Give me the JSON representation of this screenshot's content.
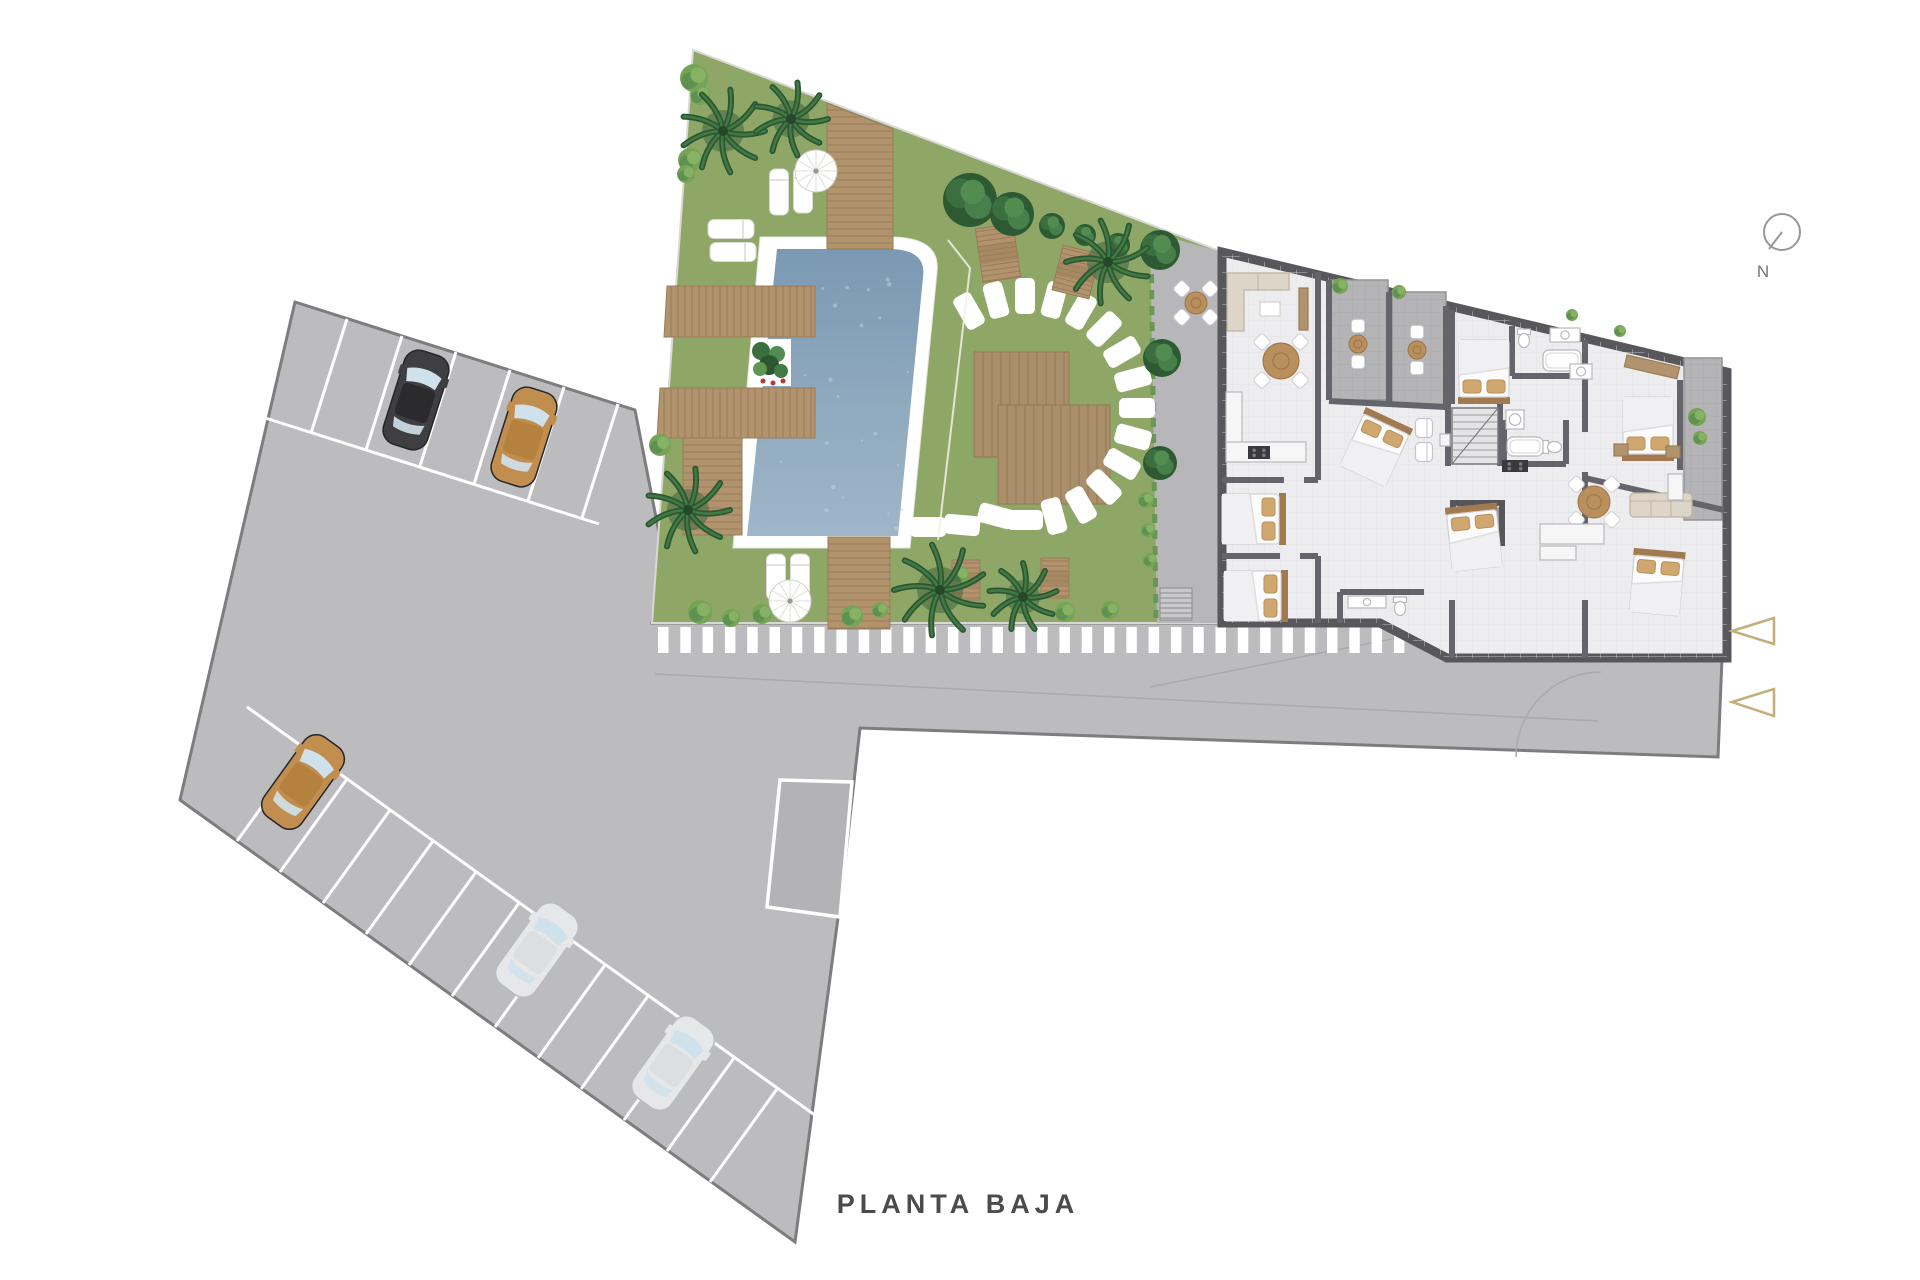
{
  "labels": {
    "title": "PLANTA BAJA",
    "north": "N"
  },
  "palette": {
    "concrete": "#bcbcbe",
    "concreteEdge": "#7d7d80",
    "ramp": "#b3b3b5",
    "grass": "#8ea766",
    "grassEdge": "#d8d8d4",
    "wood": "#b1946e",
    "woodLine": "#997c57",
    "pergola": "#aa8f6a",
    "pergolaLine": "#937a55",
    "poolTop": "#7b99b4",
    "poolBottom": "#9fb6c8",
    "wall": "#58585c",
    "floor": "#ededef",
    "terrace": "#b4b4b6",
    "plaza": "#b7b7b9",
    "white": "#ffffff",
    "beige": "#ddd5c8",
    "pillow": "#cfa76f",
    "headboard": "#a17a50",
    "palmDark": "#2d5733",
    "palmMid": "#417a43",
    "palmLight": "#5c9653",
    "bushLight": "#76a457",
    "arrow": "#c6ae7c",
    "compass": "#97979a",
    "carBlack": "#3f3f42",
    "carTan": "#c28e50",
    "carSilver": "#e6e7e8",
    "glass": "#cfe2ec"
  },
  "counts": {
    "cars": 5,
    "entrance_arrows": 2,
    "pools": 1
  },
  "scene": [
    {
      "t": "poly",
      "name": "parking-lot-and-road",
      "pts": "295,302 635,410 662,548 652,623 1380,623 1447,658 1722,658 1718,757 860,728 843,880 795,1242 180,800",
      "fill": "concrete",
      "stroke": "concreteEdge",
      "sw": 3
    },
    {
      "t": "lineset",
      "name": "road-guide-lines",
      "seg": [
        [
          655,
          674,
          1598,
          721
        ],
        [
          1150,
          687,
          1421,
          633
        ]
      ],
      "stroke": "#aaaaac",
      "sw": 1.5
    },
    {
      "t": "path",
      "name": "road-turning-arc",
      "d": "M1516,757 A85,85 0 0 1 1601,672",
      "stroke": "#aaaaac",
      "sw": 1.5,
      "fill": "none"
    },
    {
      "t": "poly",
      "name": "garage-ramp",
      "pts": "780,780 852,782 840,917 767,907",
      "fill": "ramp",
      "stroke": "#ffffff",
      "sw": 3.5
    },
    {
      "t": "lineset",
      "name": "parking-row-top-line",
      "seg": [
        [
          259,
          416,
          599,
          524
        ]
      ],
      "stroke": "#ffffff",
      "sw": 3
    },
    {
      "t": "lineset",
      "name": "parking-row-top-dividers",
      "seg": [
        [
          347,
          319,
          311,
          433
        ],
        [
          402,
          336,
          366,
          450
        ],
        [
          456,
          352,
          420,
          466
        ],
        [
          510,
          370,
          474,
          484
        ],
        [
          564,
          387,
          528,
          501
        ],
        [
          618,
          404,
          582,
          518
        ]
      ],
      "stroke": "#ffffff",
      "sw": 3
    },
    {
      "t": "lineset",
      "name": "parking-row-bottom-line",
      "seg": [
        [
          247,
          707,
          862,
          1149
        ]
      ],
      "stroke": "#ffffff",
      "sw": 3
    },
    {
      "t": "lineset",
      "name": "parking-row-bottom-dividers",
      "seg": [
        [
          237,
          841,
          304,
          748
        ],
        [
          280,
          872,
          347,
          779
        ],
        [
          323,
          903,
          390,
          810
        ],
        [
          366,
          934,
          433,
          841
        ],
        [
          409,
          965,
          476,
          872
        ],
        [
          452,
          996,
          519,
          903
        ],
        [
          495,
          1027,
          562,
          934
        ],
        [
          538,
          1058,
          605,
          965
        ],
        [
          581,
          1089,
          648,
          996
        ],
        [
          624,
          1120,
          691,
          1027
        ],
        [
          667,
          1151,
          734,
          1058
        ],
        [
          710,
          1182,
          777,
          1089
        ]
      ],
      "stroke": "#ffffff",
      "sw": 3
    },
    {
      "t": "crosswalk",
      "name": "walkway-stripes",
      "x0": 658,
      "y": 627,
      "w": 10.5,
      "h": 26,
      "step": 22.3,
      "count": 34
    },
    {
      "t": "car",
      "name": "parked-car-black",
      "x": 416,
      "y": 400,
      "rot": 17.6,
      "c": "carBlack"
    },
    {
      "t": "car",
      "name": "parked-car-tan",
      "x": 524,
      "y": 437,
      "rot": 17.6,
      "c": "carTan"
    },
    {
      "t": "car",
      "name": "parked-car-tan",
      "x": 303,
      "y": 782,
      "rot": 35.7,
      "c": "carTan"
    },
    {
      "t": "car",
      "name": "parked-car-silver",
      "x": 537,
      "y": 950,
      "rot": 35.7,
      "c": "carSilver"
    },
    {
      "t": "car",
      "name": "parked-car-silver",
      "x": 673,
      "y": 1063,
      "rot": 35.7,
      "c": "carSilver"
    },
    {
      "t": "poly",
      "name": "garden-lawn",
      "pts": "693,50 1222,252 1222,623 652,623",
      "fill": "grass",
      "stroke": "grassEdge",
      "sw": 2
    },
    {
      "t": "poly",
      "name": "plaza-paving",
      "pts": "1150,232 1222,252 1222,623 1157,623",
      "fill": "plaza"
    },
    {
      "t": "hedge",
      "name": "plaza-hedge",
      "x1": 1151,
      "y1": 242,
      "x2": 1156,
      "y2": 618
    },
    {
      "t": "steps",
      "name": "plaza-steps",
      "x": 1160,
      "y": 588,
      "w": 32,
      "h": 32
    },
    {
      "t": "path",
      "name": "pool-surround",
      "d": "M760,237 L890,237 Q941,237 937,272 L910,548 L733,548 Z",
      "fill": "#ffffff",
      "stroke": "#e3e3df",
      "sw": 1
    },
    {
      "t": "pool",
      "name": "swimming-pool",
      "d": "M777,249 L888,249 Q927,249 923,277 L898,536 L747,536 Z"
    },
    {
      "t": "deck",
      "name": "wood-deck",
      "pts": "827,103 893,129 893,249 827,249",
      "dir": "h"
    },
    {
      "t": "deck",
      "name": "wood-deck",
      "pts": "667,286 815,286 815,337 664,337",
      "dir": "v"
    },
    {
      "t": "deck",
      "name": "wood-deck",
      "pts": "660,388 815,388 815,438 657,438",
      "dir": "v"
    },
    {
      "t": "deck",
      "name": "wood-deck",
      "pts": "828,537 890,537 890,629 828,629",
      "dir": "h"
    },
    {
      "t": "deck",
      "name": "wood-deck",
      "pts": "683,438 742,438 742,535 683,535",
      "dir": "h"
    },
    {
      "t": "planter",
      "name": "pool-planter",
      "x": 751,
      "y": 339,
      "w": 40,
      "h": 47
    },
    {
      "t": "deck",
      "name": "pergola-deck",
      "pts": "974,352 1069,352 1069,457 974,457",
      "dir": "v",
      "wood": "pergola",
      "line": "pergolaLine",
      "sp": 9
    },
    {
      "t": "deck",
      "name": "pergola-deck",
      "pts": "998,405 1110,405 1110,504 998,504",
      "dir": "v",
      "wood": "pergola",
      "line": "pergolaLine",
      "sp": 9
    },
    {
      "t": "stones",
      "name": "stepping-stones",
      "list": [
        [
          969,
          311,
          -120
        ],
        [
          996,
          300,
          -105
        ],
        [
          1025,
          296,
          -90
        ],
        [
          1054,
          300,
          -75
        ],
        [
          1081,
          311,
          -60
        ],
        [
          1104,
          329,
          -45
        ],
        [
          1122,
          352,
          -30
        ],
        [
          1133,
          379,
          -15
        ],
        [
          1137,
          408,
          0
        ],
        [
          1133,
          437,
          15
        ],
        [
          1122,
          464,
          30
        ],
        [
          1104,
          487,
          45
        ],
        [
          1081,
          505,
          60
        ],
        [
          1054,
          516,
          75
        ],
        [
          1025,
          520,
          0
        ],
        [
          996,
          516,
          15
        ],
        [
          962,
          525,
          5
        ],
        [
          928,
          527,
          0
        ]
      ]
    },
    {
      "t": "pathline",
      "name": "lawn-edge-line",
      "pts": [
        [
          948,
          240
        ],
        [
          970,
          268
        ],
        [
          938,
          540
        ]
      ]
    },
    {
      "t": "lounger",
      "x": 731,
      "y": 229,
      "rot": 90
    },
    {
      "t": "lounger",
      "x": 733,
      "y": 252,
      "rot": 90
    },
    {
      "t": "lounger",
      "x": 779,
      "y": 192,
      "rot": 0
    },
    {
      "t": "lounger",
      "x": 803,
      "y": 190,
      "rot": 0
    },
    {
      "t": "lounger",
      "x": 776,
      "y": 577,
      "rot": 0
    },
    {
      "t": "lounger",
      "x": 800,
      "y": 577,
      "rot": 0
    },
    {
      "t": "parasol",
      "x": 816,
      "y": 171
    },
    {
      "t": "parasol",
      "x": 790,
      "y": 601
    },
    {
      "t": "picnic",
      "x": 998,
      "y": 253,
      "w": 38,
      "h": 54,
      "rot": -8
    },
    {
      "t": "picnic",
      "x": 1076,
      "y": 272,
      "w": 38,
      "h": 46,
      "rot": 14
    },
    {
      "t": "picnic",
      "x": 966,
      "y": 580,
      "w": 28,
      "h": 40,
      "rot": 0
    },
    {
      "t": "picnic",
      "x": 1055,
      "y": 578,
      "w": 28,
      "h": 40,
      "rot": 0
    },
    {
      "t": "bistro",
      "name": "plaza-bistro",
      "x": 1196,
      "y": 303,
      "r": 11,
      "n": 4
    },
    {
      "t": "tree",
      "x": 970,
      "y": 200,
      "r": 27
    },
    {
      "t": "tree",
      "x": 1012,
      "y": 214,
      "r": 22
    },
    {
      "t": "tree",
      "x": 1052,
      "y": 226,
      "r": 13
    },
    {
      "t": "tree",
      "x": 1085,
      "y": 235,
      "r": 11
    },
    {
      "t": "tree",
      "x": 1118,
      "y": 245,
      "r": 12
    },
    {
      "t": "tree",
      "x": 1160,
      "y": 250,
      "r": 20
    },
    {
      "t": "tree",
      "x": 1162,
      "y": 358,
      "r": 19
    },
    {
      "t": "tree",
      "x": 1160,
      "y": 463,
      "r": 17
    },
    {
      "t": "bush",
      "x": 694,
      "y": 78,
      "r": 14
    },
    {
      "t": "bush",
      "x": 700,
      "y": 95,
      "r": 10
    },
    {
      "t": "bush",
      "x": 690,
      "y": 160,
      "r": 12
    },
    {
      "t": "bush",
      "x": 686,
      "y": 174,
      "r": 9
    },
    {
      "t": "bush",
      "x": 660,
      "y": 445,
      "r": 11
    },
    {
      "t": "bush",
      "x": 700,
      "y": 612,
      "r": 12
    },
    {
      "t": "bush",
      "x": 731,
      "y": 618,
      "r": 9
    },
    {
      "t": "bush",
      "x": 762,
      "y": 614,
      "r": 10
    },
    {
      "t": "bush",
      "x": 852,
      "y": 616,
      "r": 11
    },
    {
      "t": "bush",
      "x": 880,
      "y": 610,
      "r": 8
    },
    {
      "t": "bush",
      "x": 1065,
      "y": 612,
      "r": 10
    },
    {
      "t": "bush",
      "x": 1110,
      "y": 610,
      "r": 9
    },
    {
      "t": "bush",
      "x": 1146,
      "y": 500,
      "r": 8
    },
    {
      "t": "bush",
      "x": 1148,
      "y": 530,
      "r": 7
    },
    {
      "t": "bush",
      "x": 1150,
      "y": 560,
      "r": 7
    },
    {
      "t": "bush",
      "x": 960,
      "y": 575,
      "r": 9
    },
    {
      "t": "palm",
      "x": 723,
      "y": 131,
      "r": 42
    },
    {
      "t": "palm",
      "x": 791,
      "y": 119,
      "r": 37,
      "rot": 20
    },
    {
      "t": "palm",
      "x": 688,
      "y": 510,
      "r": 42,
      "rot": 40
    },
    {
      "t": "palm",
      "x": 940,
      "y": 590,
      "r": 46,
      "rot": 10
    },
    {
      "t": "palm",
      "x": 1023,
      "y": 597,
      "r": 34,
      "rot": 55
    },
    {
      "t": "palm",
      "x": 1108,
      "y": 262,
      "r": 42,
      "rot": 30
    },
    {
      "t": "building",
      "name": "building-floor",
      "pts": "1222,252 1727,372 1727,658 1447,658 1380,623 1222,623"
    },
    {
      "t": "terrace",
      "name": "apartment-terrace",
      "x": 1331,
      "y": 280,
      "w": 57,
      "h": 120
    },
    {
      "t": "terrace",
      "name": "apartment-terrace",
      "x": 1392,
      "y": 292,
      "w": 54,
      "h": 114
    },
    {
      "t": "terrace",
      "name": "side-balcony",
      "x": 1684,
      "y": 358,
      "w": 38,
      "h": 162
    },
    {
      "t": "walls",
      "name": "interior-walls",
      "seg": [
        [
          1318,
          272,
          1318,
          480
        ],
        [
          1318,
          556,
          1318,
          623
        ],
        [
          1452,
          310,
          1452,
          404
        ],
        [
          1448,
          404,
          1448,
          466
        ],
        [
          1500,
          404,
          1500,
          466
        ],
        [
          1452,
          600,
          1452,
          658
        ],
        [
          1585,
          340,
          1585,
          432
        ],
        [
          1585,
          472,
          1585,
          524
        ],
        [
          1585,
          600,
          1585,
          658
        ],
        [
          1329,
          280,
          1329,
          400
        ],
        [
          1389,
          292,
          1389,
          404
        ],
        [
          1446,
          306,
          1446,
          410
        ],
        [
          1329,
          401,
          1446,
          407
        ],
        [
          1222,
          480,
          1284,
          480
        ],
        [
          1304,
          480,
          1318,
          480
        ],
        [
          1222,
          556,
          1280,
          556
        ],
        [
          1300,
          556,
          1318,
          556
        ],
        [
          1512,
          326,
          1512,
          376
        ],
        [
          1512,
          376,
          1588,
          376
        ],
        [
          1504,
          420,
          1504,
          464
        ],
        [
          1504,
          464,
          1566,
          464
        ],
        [
          1566,
          420,
          1566,
          464
        ],
        [
          1340,
          592,
          1340,
          623
        ],
        [
          1340,
          592,
          1424,
          592
        ],
        [
          1585,
          478,
          1724,
          510
        ],
        [
          1680,
          380,
          1680,
          470
        ]
      ]
    },
    {
      "t": "stairs",
      "x": 1452,
      "y": 408,
      "w": 46,
      "h": 56
    },
    {
      "t": "elevator",
      "x": 1450,
      "y": 500,
      "w": 55,
      "h": 46
    },
    {
      "t": "bed",
      "x": 1254,
      "y": 519,
      "rot": 90
    },
    {
      "t": "bed",
      "x": 1256,
      "y": 596,
      "rot": 90
    },
    {
      "t": "bed",
      "x": 1376,
      "y": 447,
      "rot": 25
    },
    {
      "t": "bed",
      "x": 1484,
      "y": 372,
      "rot": 180
    },
    {
      "t": "bed",
      "x": 1474,
      "y": 537,
      "rot": -6
    },
    {
      "t": "bed",
      "x": 1648,
      "y": 429,
      "rot": 180
    },
    {
      "t": "bed",
      "x": 1657,
      "y": 582,
      "rot": 5
    },
    {
      "t": "sofaL",
      "x": 1258,
      "y": 302,
      "rot": 0
    },
    {
      "t": "sofa",
      "x": 1661,
      "y": 505,
      "rot": 0
    },
    {
      "t": "armchair",
      "x": 1424,
      "y": 428,
      "rot": 90
    },
    {
      "t": "armchair",
      "x": 1424,
      "y": 452,
      "rot": 90
    },
    {
      "t": "counter",
      "x": 1440,
      "y": 434,
      "w": 10,
      "h": 12
    },
    {
      "t": "table",
      "x": 1281,
      "y": 361,
      "r": 18,
      "n": 6
    },
    {
      "t": "table",
      "x": 1594,
      "y": 502,
      "r": 16,
      "n": 4
    },
    {
      "t": "bistro",
      "name": "terrace-bistro",
      "x": 1358,
      "y": 344,
      "r": 9,
      "n": 2
    },
    {
      "t": "bistro",
      "name": "terrace-bistro",
      "x": 1417,
      "y": 350,
      "r": 9,
      "n": 2
    },
    {
      "t": "counter",
      "name": "tv-unit",
      "x": 1299,
      "y": 288,
      "w": 9,
      "h": 42,
      "wd": true
    },
    {
      "t": "counter",
      "name": "kitchen-counter",
      "x": 1226,
      "y": 392,
      "w": 16,
      "h": 70
    },
    {
      "t": "counter",
      "name": "kitchen-counter",
      "x": 1226,
      "y": 442,
      "w": 80,
      "h": 20
    },
    {
      "t": "cooktop",
      "x": 1248,
      "y": 446,
      "w": 22,
      "h": 13
    },
    {
      "t": "counter",
      "name": "kitchen-counter",
      "x": 1540,
      "y": 524,
      "w": 64,
      "h": 20
    },
    {
      "t": "counter",
      "name": "kitchen-island",
      "x": 1540,
      "y": 546,
      "w": 36,
      "h": 14
    },
    {
      "t": "cooktop",
      "x": 1502,
      "y": 460,
      "w": 26,
      "h": 12
    },
    {
      "t": "counter",
      "name": "desk",
      "x": 1668,
      "y": 474,
      "w": 15,
      "h": 26,
      "wd": false
    },
    {
      "t": "counter",
      "name": "dresser",
      "x": 1627,
      "y": 355,
      "w": 54,
      "h": 12,
      "wd": true,
      "rot": 13
    },
    {
      "t": "counter",
      "name": "nightstand",
      "x": 1614,
      "y": 444,
      "w": 14,
      "h": 12,
      "wd": true
    },
    {
      "t": "counter",
      "name": "nightstand",
      "x": 1666,
      "y": 446,
      "w": 14,
      "h": 12,
      "wd": true
    },
    {
      "t": "vanity",
      "x": 1550,
      "y": 328,
      "w": 30,
      "h": 14
    },
    {
      "t": "toilet",
      "x": 1524,
      "y": 338,
      "rot": 0
    },
    {
      "t": "tub",
      "x": 1543,
      "y": 350,
      "w": 38,
      "h": 21
    },
    {
      "t": "shower",
      "x": 1506,
      "y": 410,
      "w": 18,
      "h": 19
    },
    {
      "t": "tub",
      "x": 1507,
      "y": 437,
      "w": 36,
      "h": 19
    },
    {
      "t": "toilet",
      "x": 1552,
      "y": 447,
      "rot": -90
    },
    {
      "t": "vanity",
      "x": 1348,
      "y": 596,
      "w": 38,
      "h": 12
    },
    {
      "t": "toilet",
      "x": 1400,
      "y": 606,
      "rot": 0
    },
    {
      "t": "vanity",
      "x": 1570,
      "y": 364,
      "w": 22,
      "h": 15
    },
    {
      "t": "bush",
      "x": 1340,
      "y": 286,
      "r": 8
    },
    {
      "t": "bush",
      "x": 1399,
      "y": 292,
      "r": 7
    },
    {
      "t": "bush",
      "x": 1572,
      "y": 315,
      "r": 6
    },
    {
      "t": "bush",
      "x": 1620,
      "y": 331,
      "r": 6
    },
    {
      "t": "bush",
      "x": 1697,
      "y": 417,
      "r": 9
    },
    {
      "t": "bush",
      "x": 1700,
      "y": 438,
      "r": 7
    },
    {
      "t": "arrow",
      "name": "entrance-arrow",
      "pts": "1732,631 1774,618 1774,644"
    },
    {
      "t": "arrow",
      "name": "entrance-arrow",
      "pts": "1732,702 1774,689 1774,716"
    }
  ],
  "compass": {
    "cx": 1782,
    "cy": 232,
    "r": 18,
    "nx": 1763,
    "ny": 277,
    "needle": [
      1782,
      232,
      1769,
      249
    ]
  }
}
